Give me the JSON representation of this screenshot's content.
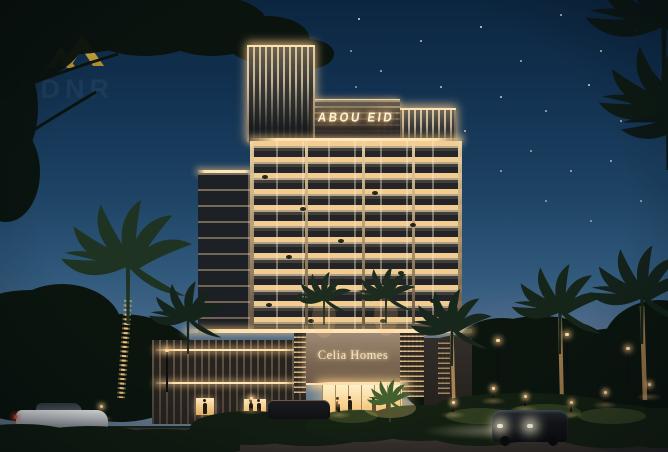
{
  "watermark": {
    "text": "ADNR",
    "icon": "double-chevron-logo",
    "gold": "#d7b13d",
    "navy": "#1e3c5a"
  },
  "building": {
    "rooftop_sign": "ABOU EID",
    "podium_sign": "Celia Homes"
  },
  "palette": {
    "sky_top": "#0c2640",
    "sky_mid": "#1d4263",
    "sky_horizon": "#66798c",
    "warm_light": "#ffd9a2",
    "facade_glow": "#e8c284",
    "foliage": "#0b150e",
    "road": "#2b282b"
  }
}
